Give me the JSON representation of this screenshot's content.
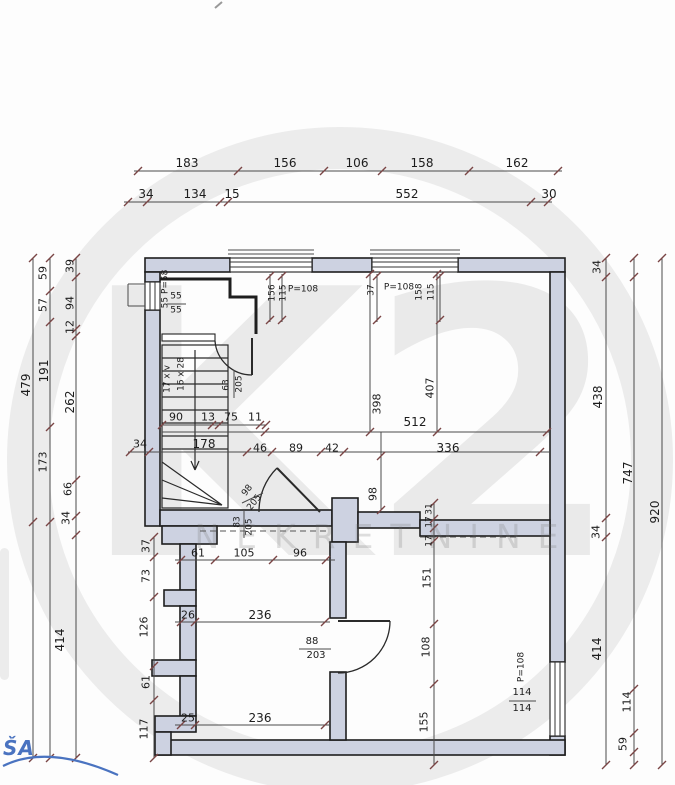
{
  "watermark": {
    "logo": "K2",
    "brand": "NEKRETNINE",
    "gray": "#e8e8e8"
  },
  "signature": {
    "text": "ŠA",
    "color": "#4a73c0"
  },
  "colors": {
    "wall_fill": "#cdd2e1",
    "line": "#4a4a4a",
    "tick": "#7a4545",
    "text": "#1c1c1c"
  },
  "plan": {
    "top_dims_row1": [
      "183",
      "156",
      "106",
      "158",
      "162"
    ],
    "top_dims_row2": [
      "34",
      "134",
      "15",
      "552",
      "30"
    ],
    "left_dims_outer": [
      "479"
    ],
    "left_dims_middle": [
      "59",
      "57",
      "191",
      "173",
      "414"
    ],
    "left_dims_inner": [
      "39",
      "94",
      "12",
      "262",
      "66",
      "34"
    ],
    "left_dims_lower": [
      "37",
      "73",
      "126",
      "61",
      "117"
    ],
    "right_dims_inner": [
      "34",
      "438",
      "34",
      "414"
    ],
    "right_dims_middle": [
      "747",
      "114",
      "59"
    ],
    "right_dims_outer": [
      "920"
    ],
    "stair_note": [
      "17 x v",
      "16 x 28"
    ],
    "door_labels": [
      "63/205",
      "98/205",
      "83/205",
      "88/203"
    ],
    "window_labels": [
      "55 P=58",
      "55/55",
      "156 115 P=108",
      "37 P=108 158 115",
      "P=108 114/114"
    ]
  },
  "labels": [
    {
      "t": "183",
      "x": 187,
      "y": 163,
      "fs": 12
    },
    {
      "t": "156",
      "x": 285,
      "y": 163,
      "fs": 12
    },
    {
      "t": "106",
      "x": 357,
      "y": 163,
      "fs": 12
    },
    {
      "t": "158",
      "x": 422,
      "y": 163,
      "fs": 12
    },
    {
      "t": "162",
      "x": 517,
      "y": 163,
      "fs": 12
    },
    {
      "t": "34",
      "x": 146,
      "y": 194,
      "fs": 12
    },
    {
      "t": "134",
      "x": 195,
      "y": 194,
      "fs": 12
    },
    {
      "t": "15",
      "x": 232,
      "y": 194,
      "fs": 12
    },
    {
      "t": "552",
      "x": 407,
      "y": 194,
      "fs": 12
    },
    {
      "t": "30",
      "x": 549,
      "y": 194,
      "fs": 12
    },
    {
      "t": "479",
      "x": 26,
      "y": 385,
      "r": -90,
      "fs": 12
    },
    {
      "t": "59",
      "x": 43,
      "y": 273,
      "r": -90
    },
    {
      "t": "57",
      "x": 43,
      "y": 305,
      "r": -90
    },
    {
      "t": "191",
      "x": 44,
      "y": 371,
      "r": -90,
      "fs": 12
    },
    {
      "t": "173",
      "x": 43,
      "y": 462,
      "r": -90
    },
    {
      "t": "414",
      "x": 60,
      "y": 640,
      "r": -90,
      "fs": 12
    },
    {
      "t": "39",
      "x": 70,
      "y": 266,
      "r": -90
    },
    {
      "t": "94",
      "x": 70,
      "y": 303,
      "r": -90
    },
    {
      "t": "12",
      "x": 70,
      "y": 327,
      "r": -90
    },
    {
      "t": "262",
      "x": 70,
      "y": 402,
      "r": -90,
      "fs": 12
    },
    {
      "t": "66",
      "x": 68,
      "y": 489,
      "r": -90
    },
    {
      "t": "34",
      "x": 66,
      "y": 518,
      "r": -90
    },
    {
      "t": "37",
      "x": 146,
      "y": 546,
      "r": -90
    },
    {
      "t": "73",
      "x": 146,
      "y": 576,
      "r": -90
    },
    {
      "t": "126",
      "x": 144,
      "y": 627,
      "r": -90
    },
    {
      "t": "61",
      "x": 146,
      "y": 682,
      "r": -90
    },
    {
      "t": "117",
      "x": 144,
      "y": 729,
      "r": -90
    },
    {
      "t": "34",
      "x": 597,
      "y": 267,
      "r": -90
    },
    {
      "t": "438",
      "x": 598,
      "y": 397,
      "r": -90,
      "fs": 12
    },
    {
      "t": "34",
      "x": 596,
      "y": 532,
      "r": -90
    },
    {
      "t": "414",
      "x": 597,
      "y": 649,
      "r": -90,
      "fs": 12
    },
    {
      "t": "747",
      "x": 628,
      "y": 473,
      "r": -90,
      "fs": 12
    },
    {
      "t": "114",
      "x": 627,
      "y": 702,
      "r": -90
    },
    {
      "t": "59",
      "x": 623,
      "y": 744,
      "r": -90
    },
    {
      "t": "920",
      "x": 655,
      "y": 512,
      "r": -90,
      "fs": 12
    },
    {
      "t": "55 P=58",
      "x": 166,
      "y": 289,
      "r": -90,
      "fs": 9
    },
    {
      "t": "55",
      "x": 176,
      "y": 297,
      "fs": 9
    },
    {
      "t": "55",
      "x": 176,
      "y": 311,
      "fs": 9
    },
    {
      "t": "156",
      "x": 273,
      "y": 293,
      "r": -90,
      "fs": 9
    },
    {
      "t": "115",
      "x": 284,
      "y": 293,
      "r": -90,
      "fs": 9
    },
    {
      "t": "P=108",
      "x": 303,
      "y": 290,
      "fs": 9
    },
    {
      "t": "37",
      "x": 372,
      "y": 290,
      "r": -90,
      "fs": 9
    },
    {
      "t": "P=108",
      "x": 399,
      "y": 288,
      "fs": 9
    },
    {
      "t": "158",
      "x": 420,
      "y": 292,
      "r": -90,
      "fs": 9
    },
    {
      "t": "115",
      "x": 432,
      "y": 292,
      "r": -90,
      "fs": 9
    },
    {
      "t": "17 x v",
      "x": 168,
      "y": 379,
      "r": -90,
      "fs": 9
    },
    {
      "t": "16 x 28",
      "x": 182,
      "y": 374,
      "r": -90,
      "fs": 9
    },
    {
      "t": "63",
      "x": 227,
      "y": 385,
      "r": -90,
      "fs": 9
    },
    {
      "t": "205",
      "x": 240,
      "y": 384,
      "r": -90,
      "fs": 9
    },
    {
      "t": "90",
      "x": 176,
      "y": 417
    },
    {
      "t": "13",
      "x": 208,
      "y": 417
    },
    {
      "t": "75",
      "x": 231,
      "y": 417
    },
    {
      "t": "11",
      "x": 255,
      "y": 417
    },
    {
      "t": "398",
      "x": 377,
      "y": 404,
      "r": -90
    },
    {
      "t": "407",
      "x": 430,
      "y": 388,
      "r": -90
    },
    {
      "t": "512",
      "x": 415,
      "y": 422,
      "fs": 12
    },
    {
      "t": "34",
      "x": 140,
      "y": 444
    },
    {
      "t": "178",
      "x": 204,
      "y": 444,
      "fs": 12
    },
    {
      "t": "46",
      "x": 260,
      "y": 448
    },
    {
      "t": "89",
      "x": 296,
      "y": 448
    },
    {
      "t": "42",
      "x": 332,
      "y": 448
    },
    {
      "t": "336",
      "x": 448,
      "y": 448,
      "fs": 12
    },
    {
      "t": "98",
      "x": 248,
      "y": 491,
      "r": -52,
      "fs": 9
    },
    {
      "t": "205",
      "x": 255,
      "y": 503,
      "r": -52,
      "fs": 9
    },
    {
      "t": "83",
      "x": 238,
      "y": 522,
      "r": -90,
      "fs": 9
    },
    {
      "t": "205",
      "x": 250,
      "y": 527,
      "r": -90,
      "fs": 9
    },
    {
      "t": "98",
      "x": 373,
      "y": 494,
      "r": -90
    },
    {
      "t": "31",
      "x": 430,
      "y": 509,
      "r": -90,
      "fs": 9
    },
    {
      "t": "17",
      "x": 430,
      "y": 522,
      "r": -90,
      "fs": 9
    },
    {
      "t": "17",
      "x": 430,
      "y": 541,
      "r": -90,
      "fs": 9
    },
    {
      "t": "151",
      "x": 427,
      "y": 578,
      "r": -90
    },
    {
      "t": "108",
      "x": 426,
      "y": 647,
      "r": -90
    },
    {
      "t": "155",
      "x": 424,
      "y": 722,
      "r": -90
    },
    {
      "t": "61",
      "x": 198,
      "y": 553
    },
    {
      "t": "105",
      "x": 244,
      "y": 553
    },
    {
      "t": "96",
      "x": 300,
      "y": 553
    },
    {
      "t": "26",
      "x": 188,
      "y": 615
    },
    {
      "t": "236",
      "x": 260,
      "y": 615,
      "fs": 12
    },
    {
      "t": "88",
      "x": 312,
      "y": 642,
      "fs": 10
    },
    {
      "t": "203",
      "x": 316,
      "y": 656,
      "fs": 10
    },
    {
      "t": "25",
      "x": 188,
      "y": 718
    },
    {
      "t": "236",
      "x": 260,
      "y": 718,
      "fs": 12
    },
    {
      "t": "P=108",
      "x": 522,
      "y": 667,
      "r": -90,
      "fs": 9
    },
    {
      "t": "114",
      "x": 522,
      "y": 693,
      "fs": 10
    },
    {
      "t": "114",
      "x": 522,
      "y": 709,
      "fs": 10
    }
  ]
}
